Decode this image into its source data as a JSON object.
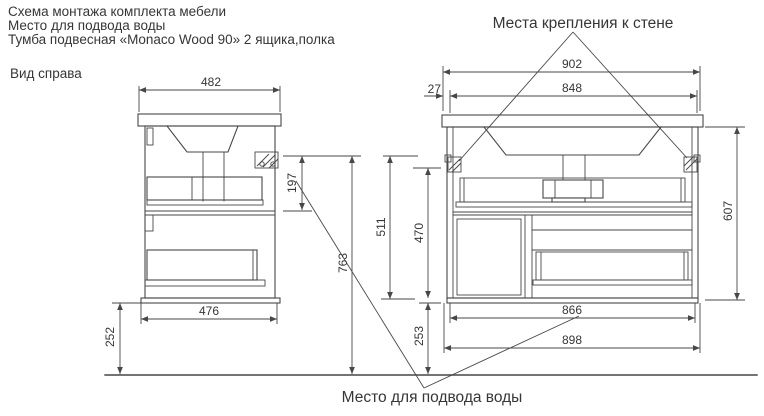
{
  "page": {
    "background": "#ffffff",
    "line_color": "#474747",
    "text_color": "#363636"
  },
  "header": {
    "line1": "Схема монтажа комплекта мебели",
    "line2": "Место для подвода воды",
    "line3": "Тумба подвесная «Monaco Wood 90» 2 ящика,полка"
  },
  "callouts": {
    "wall_mount": "Места крепления к стене",
    "water_supply": "Место для подвода воды"
  },
  "side_view": {
    "label": "Вид справа",
    "dim_top_width": "482",
    "dim_bottom_width": "476",
    "dim_bracket_drop": "197",
    "dim_floor_clearance": "252",
    "dim_mount_height": "763"
  },
  "front_view": {
    "dim_total_width": "902",
    "dim_mount_span": "848",
    "dim_edge_to_mount": "27",
    "dim_mount_to_bottom": "511",
    "dim_inner_height": "470",
    "dim_body_height": "607",
    "dim_inner_width": "866",
    "dim_body_width": "898",
    "dim_floor_clearance": "253"
  }
}
